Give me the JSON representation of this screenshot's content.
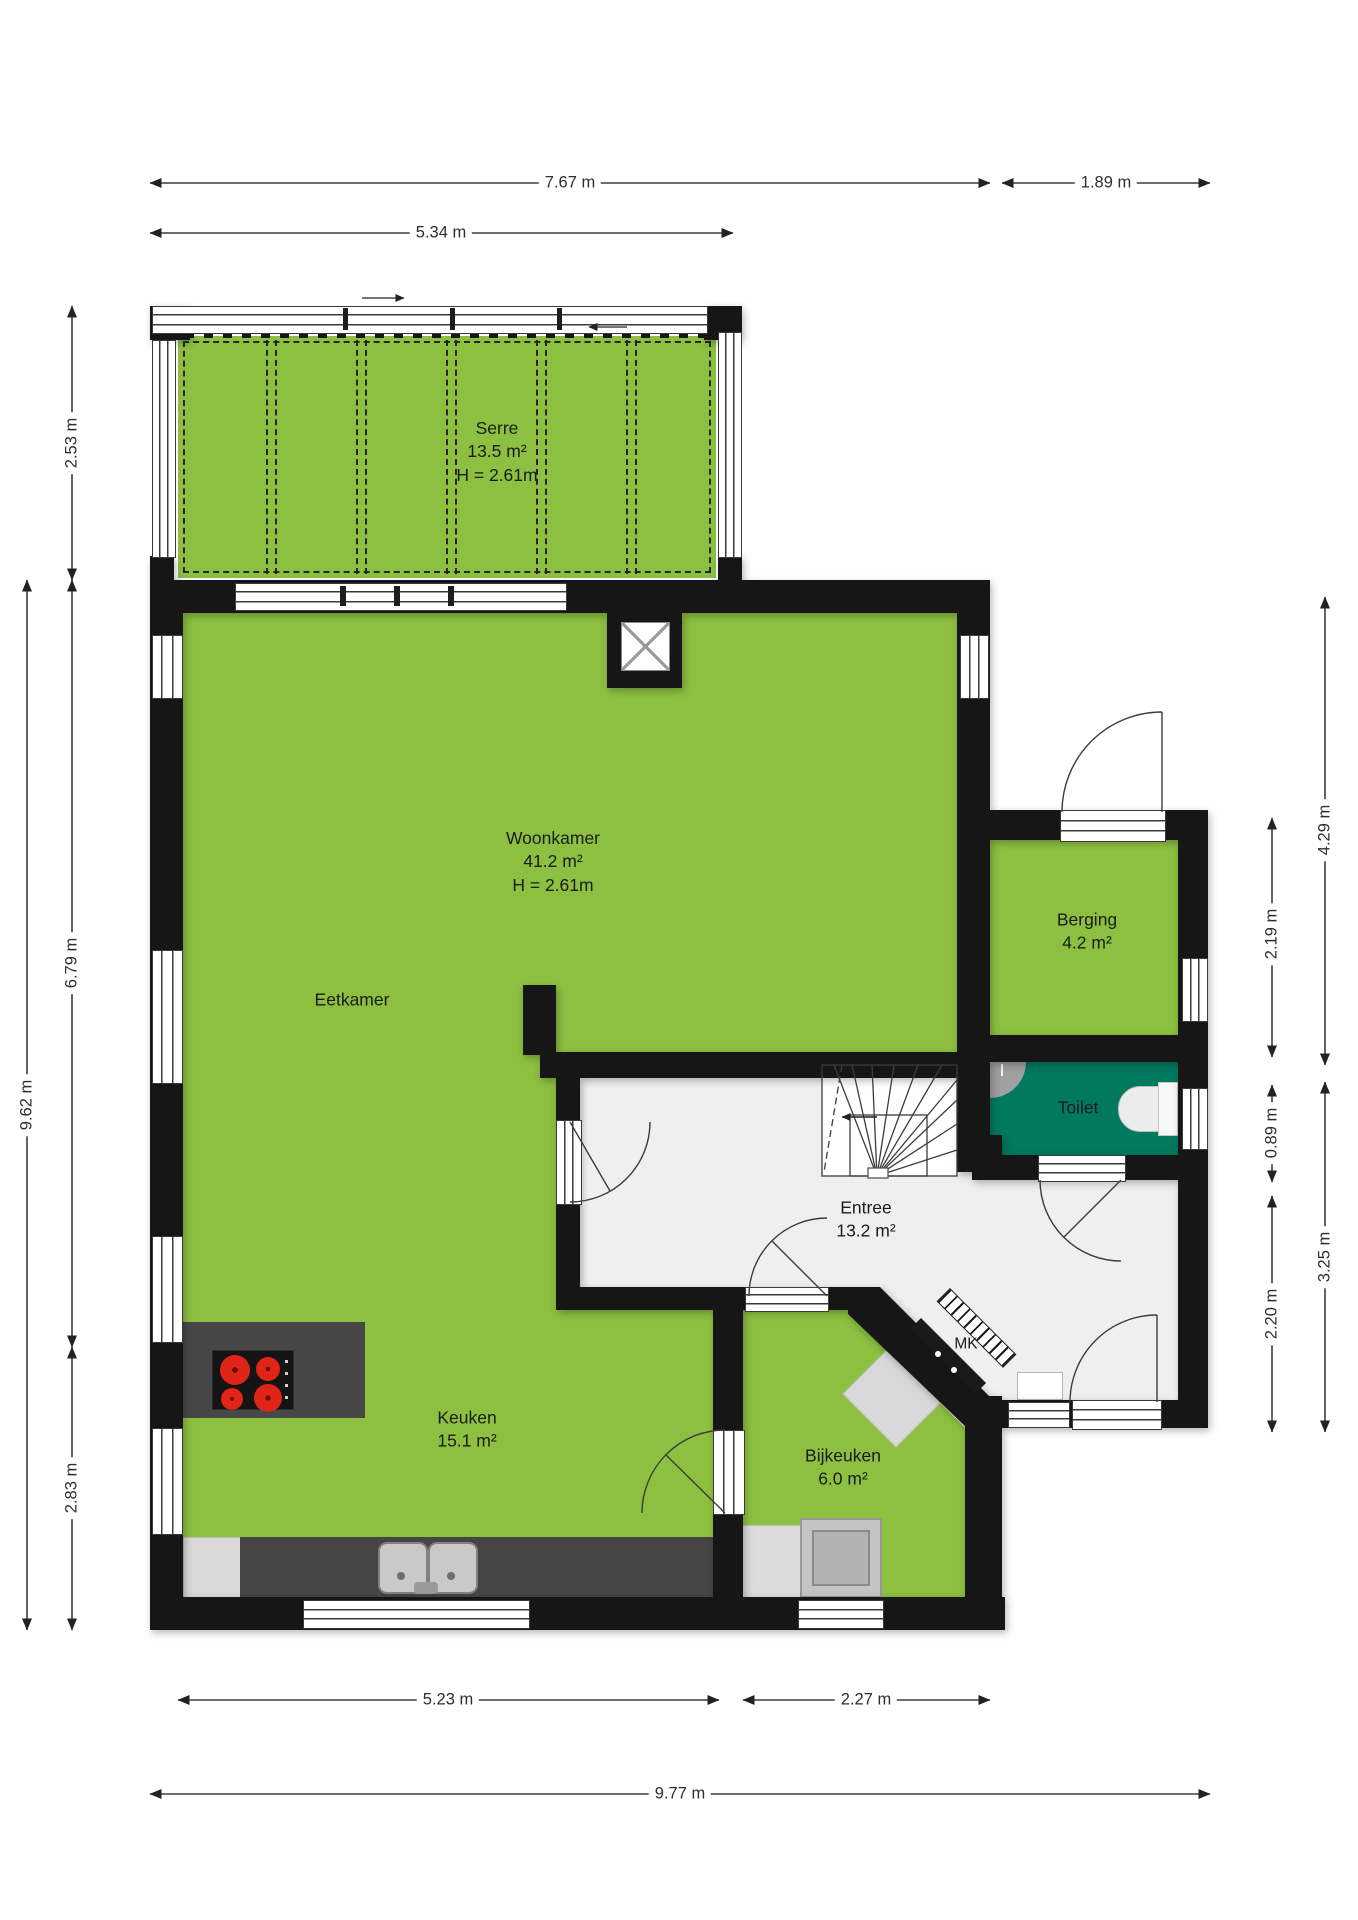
{
  "floorplan": {
    "rooms": {
      "serre": {
        "name": "Serre",
        "area": "13.5 m²",
        "ceiling": "H = 2.61m"
      },
      "woonkamer": {
        "name": "Woonkamer",
        "area": "41.2 m²",
        "ceiling": "H = 2.61m"
      },
      "eetkamer": {
        "name": "Eetkamer"
      },
      "keuken": {
        "name": "Keuken",
        "area": "15.1 m²"
      },
      "bijkeuken": {
        "name": "Bijkeuken",
        "area": "6.0 m²"
      },
      "entree": {
        "name": "Entree",
        "area": "13.2 m²"
      },
      "berging": {
        "name": "Berging",
        "area": "4.2 m²"
      },
      "toilet": {
        "name": "Toilet"
      },
      "meterkast": {
        "name": "MK"
      }
    },
    "dimensions": {
      "top_total": "7.67 m",
      "top_wing": "1.89 m",
      "top_serre": "5.34 m",
      "left_serre": "2.53 m",
      "left_total": "9.62 m",
      "left_main": "6.79 m",
      "left_keuken": "2.83 m",
      "right_upper": "4.29 m",
      "right_berging": "2.19 m",
      "right_toilet": "0.89 m",
      "right_lower": "3.25 m",
      "right_entree": "2.20 m",
      "bottom_keuken": "5.23 m",
      "bottom_bijkeuken": "2.27 m",
      "bottom_total": "9.77 m"
    },
    "colors": {
      "room_fill": "#8dbf41",
      "toilet_fill": "#00795f",
      "hall_fill": "#efefef",
      "wall": "#161616"
    }
  }
}
